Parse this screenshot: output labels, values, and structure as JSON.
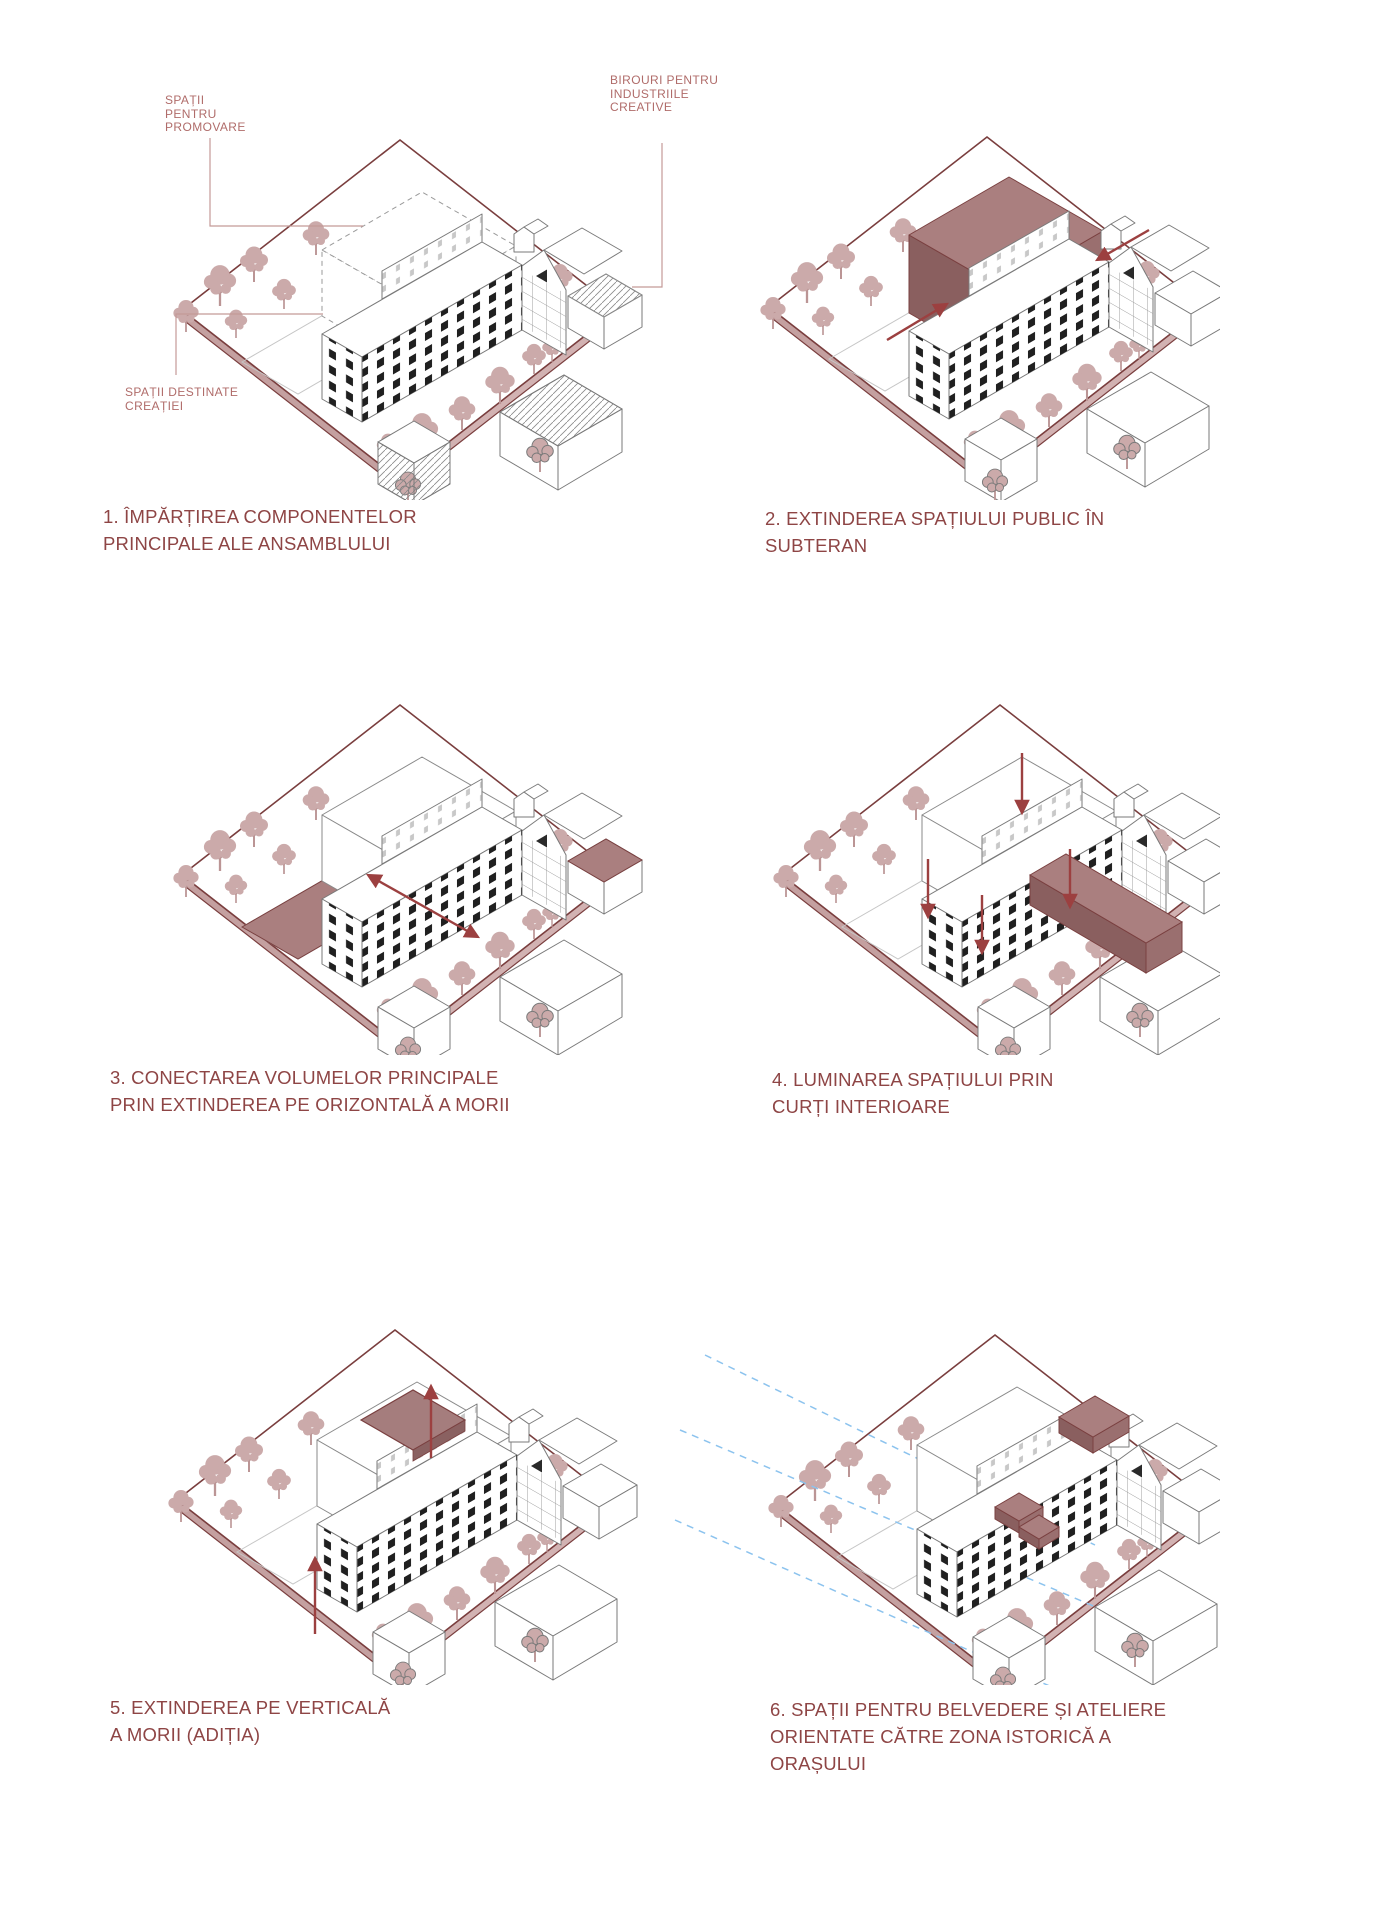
{
  "sheet": {
    "language": "Romanian",
    "content": "Architectural concept diagrams - mill complex transformation",
    "grid": "2 columns x 3 rows"
  },
  "colors": {
    "caption_text": "#8e4545",
    "annotation_text": "#b06c6a",
    "site_edge": "#7a3e3e",
    "plate_side": "#d2b2b2",
    "highlight_top": "#aa7f7f",
    "highlight_side": "#8a5f5f",
    "tree": "#cbaaaa",
    "arrow": "#9c4040",
    "sightline_blue": "#8cc3ee",
    "building_stroke": "#7a7a7a",
    "window_dark": "#202020"
  },
  "figures": [
    {
      "id": 1,
      "caption_lines": [
        "1. ÎMPĂRȚIREA COMPONENTELOR",
        "PRINCIPALE ALE ANSAMBLULUI"
      ],
      "annotations": [
        {
          "lines": [
            "SPAȚII",
            "PENTRU",
            "PROMOVARE"
          ]
        },
        {
          "lines": [
            "BIROURI PENTRU",
            "INDUSTRIILE",
            "CREATIVE"
          ]
        },
        {
          "lines": [
            "SPAȚII DESTINATE",
            "CREAȚIEI"
          ]
        }
      ],
      "highlights": "dashed promotion volume, hatched creation cubes"
    },
    {
      "id": 2,
      "caption_lines": [
        "2. EXTINDEREA SPAȚIULUI PUBLIC ÎN",
        "SUBTERAN"
      ],
      "highlights": "solid maroon underground-extension volume, two entry arrows"
    },
    {
      "id": 3,
      "caption_lines": [
        "3. CONECTAREA VOLUMELOR PRINCIPALE",
        "PRIN EXTINDEREA PE ORIZONTALĂ A MORII"
      ],
      "highlights": "maroon ground slab and roof panel, double-headed extension arrow"
    },
    {
      "id": 4,
      "caption_lines": [
        "4. LUMINAREA SPAȚIULUI PRIN",
        "CURȚI INTERIOARE"
      ],
      "highlights": "maroon light-well bar, four downward light arrows"
    },
    {
      "id": 5,
      "caption_lines": [
        "5. EXTINDEREA PE VERTICALĂ",
        "A MORII (ADIȚIA)"
      ],
      "highlights": "maroon roof opening, two upward extension arrows"
    },
    {
      "id": 6,
      "caption_lines": [
        "6. SPAȚII PENTRU BELVEDERE ȘI ATELIERE",
        "ORIENTATE CĂTRE ZONA ISTORICĂ A",
        "ORAȘULUI"
      ],
      "highlights": "maroon rooftop belvedere boxes, blue dashed sight lines to historic zone"
    }
  ]
}
